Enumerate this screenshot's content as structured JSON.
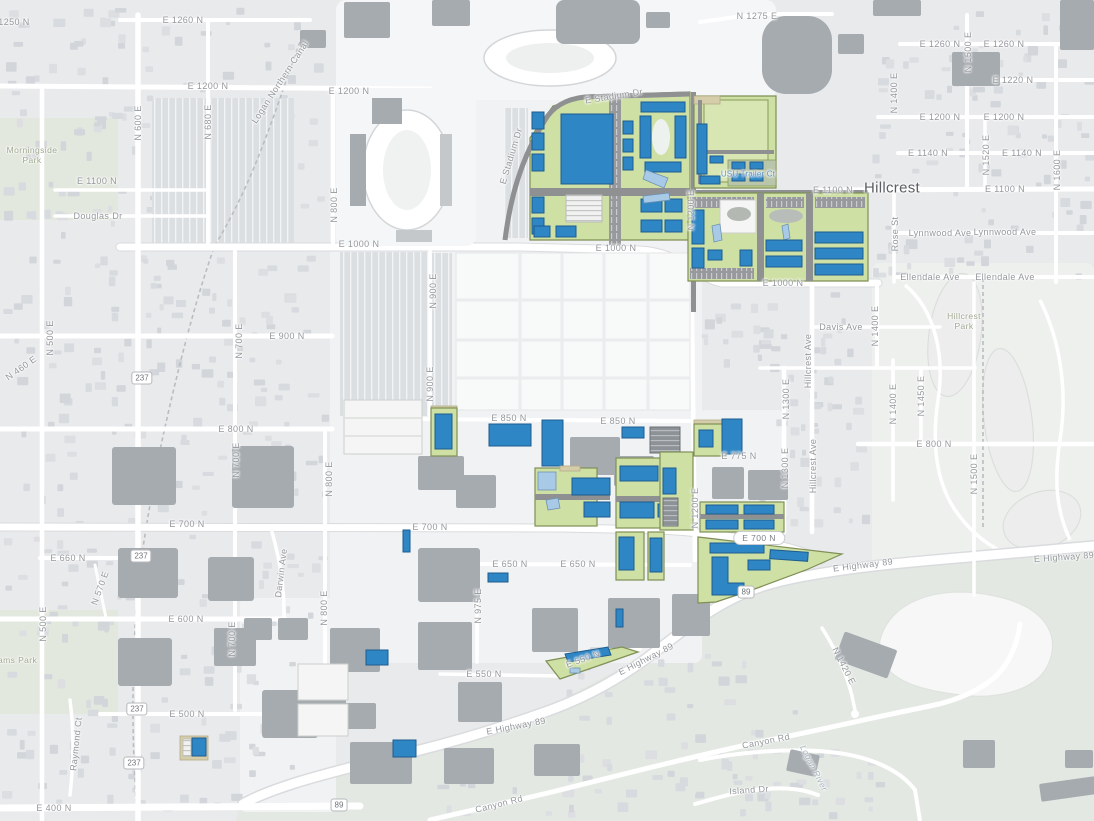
{
  "map": {
    "colors": {
      "background": "#e9eaec",
      "road": "#ffffff",
      "proposed_building_blue": "#2e86c5",
      "proposed_building_border": "#1d5c8e",
      "open_space_green": "#cfe0a5",
      "open_space_border": "#7f8f55",
      "water_feature_lightblue": "#a9cae6",
      "existing_building_gray": "#a6abb0",
      "street_label_gray": "#94989c"
    },
    "street_labels": [
      {
        "t": "1250 N",
        "x": 14,
        "y": 22
      },
      {
        "t": "E 1260 N",
        "x": 183,
        "y": 20
      },
      {
        "t": "E 1200 N",
        "x": 208,
        "y": 86
      },
      {
        "t": "E 1200 N",
        "x": 349,
        "y": 91
      },
      {
        "t": "E 1100 N",
        "x": 97,
        "y": 181
      },
      {
        "t": "Douglas Dr",
        "x": 98,
        "y": 216
      },
      {
        "t": "N 600 E",
        "x": 138,
        "y": 123,
        "r": -90
      },
      {
        "t": "N 680 E",
        "x": 208,
        "y": 122,
        "r": -90
      },
      {
        "t": "Logan Northern Canal",
        "x": 280,
        "y": 82,
        "r": -57
      },
      {
        "t": "N 1275 E",
        "x": 757,
        "y": 16
      },
      {
        "t": "E 1260 N",
        "x": 940,
        "y": 44
      },
      {
        "t": "E 1260 N",
        "x": 1004,
        "y": 44
      },
      {
        "t": "E 1220 N",
        "x": 1013,
        "y": 80
      },
      {
        "t": "E 1200 N",
        "x": 940,
        "y": 117
      },
      {
        "t": "E 1200 N",
        "x": 1004,
        "y": 117
      },
      {
        "t": "E 1140 N",
        "x": 928,
        "y": 153
      },
      {
        "t": "E 1140 N",
        "x": 1022,
        "y": 153
      },
      {
        "t": "N 1500 E",
        "x": 968,
        "y": 52,
        "r": -90
      },
      {
        "t": "N 1400 E",
        "x": 894,
        "y": 93,
        "r": -90
      },
      {
        "t": "N 1520 E",
        "x": 986,
        "y": 155,
        "r": -90
      },
      {
        "t": "N 1600 E",
        "x": 1057,
        "y": 170,
        "r": -90
      },
      {
        "t": "E 1100 N",
        "x": 833,
        "y": 190
      },
      {
        "t": "E 1100 N",
        "x": 1005,
        "y": 189
      },
      {
        "t": "Rose St",
        "x": 895,
        "y": 234,
        "r": -90
      },
      {
        "t": "Lynnwood Ave",
        "x": 940,
        "y": 233
      },
      {
        "t": "Lynnwood Ave",
        "x": 1005,
        "y": 232
      },
      {
        "t": "Ellendale Ave",
        "x": 930,
        "y": 277
      },
      {
        "t": "Ellendale Ave",
        "x": 1005,
        "y": 277
      },
      {
        "t": "E Stadium Dr",
        "x": 614,
        "y": 96,
        "r": -9
      },
      {
        "t": "E Stadium Dr",
        "x": 511,
        "y": 156,
        "r": -73
      },
      {
        "t": "N 800 E",
        "x": 334,
        "y": 205,
        "r": -90
      },
      {
        "t": "E 1000 N",
        "x": 359,
        "y": 244
      },
      {
        "t": "E 1000 N",
        "x": 616,
        "y": 248
      },
      {
        "t": "E 1000 N",
        "x": 783,
        "y": 283
      },
      {
        "t": "E 900 N",
        "x": 287,
        "y": 336
      },
      {
        "t": "N 900 E",
        "x": 433,
        "y": 291,
        "r": -90
      },
      {
        "t": "N 900 E",
        "x": 430,
        "y": 384,
        "r": -90
      },
      {
        "t": "N 500 E",
        "x": 50,
        "y": 338,
        "r": -90
      },
      {
        "t": "N 460 E",
        "x": 21,
        "y": 368,
        "r": -35
      },
      {
        "t": "N 700 E",
        "x": 239,
        "y": 341,
        "r": -90
      },
      {
        "t": "E 800 N",
        "x": 236,
        "y": 429
      },
      {
        "t": "E 800 N",
        "x": 934,
        "y": 444
      },
      {
        "t": "N 700 E",
        "x": 236,
        "y": 460,
        "r": -90
      },
      {
        "t": "E 850 N",
        "x": 509,
        "y": 418
      },
      {
        "t": "E 850 N",
        "x": 618,
        "y": 421
      },
      {
        "t": "Davis Ave",
        "x": 841,
        "y": 327
      },
      {
        "t": "N 1400 E",
        "x": 875,
        "y": 326,
        "r": -90
      },
      {
        "t": "Hillcrest Ave",
        "x": 808,
        "y": 361,
        "r": -90
      },
      {
        "t": "N 1300 E",
        "x": 786,
        "y": 399,
        "r": -90
      },
      {
        "t": "N 1400 E",
        "x": 893,
        "y": 404,
        "r": -90
      },
      {
        "t": "N 1450 E",
        "x": 921,
        "y": 396,
        "r": -90
      },
      {
        "t": "N 1500 E",
        "x": 974,
        "y": 474,
        "r": -90
      },
      {
        "t": "E 775 N",
        "x": 739,
        "y": 456
      },
      {
        "t": "Hillcrest Ave",
        "x": 813,
        "y": 466,
        "r": -90
      },
      {
        "t": "N 1300 E",
        "x": 785,
        "y": 468,
        "r": -90
      },
      {
        "t": "N 1200 E",
        "x": 695,
        "y": 508,
        "r": -90
      },
      {
        "t": "N 1200 E",
        "x": 691,
        "y": 210,
        "r": -90
      },
      {
        "t": "E 700 N",
        "x": 187,
        "y": 524
      },
      {
        "t": "E 700 N",
        "x": 430,
        "y": 527
      },
      {
        "t": "N 800 E",
        "x": 329,
        "y": 479,
        "r": -90
      },
      {
        "t": "N 800 E",
        "x": 324,
        "y": 608,
        "r": -90
      },
      {
        "t": "E 650 N",
        "x": 510,
        "y": 564
      },
      {
        "t": "E 650 N",
        "x": 578,
        "y": 564
      },
      {
        "t": "N 975 E",
        "x": 478,
        "y": 606,
        "r": -90
      },
      {
        "t": "E Highway 89",
        "x": 863,
        "y": 565,
        "r": -7
      },
      {
        "t": "E Highway 89",
        "x": 1064,
        "y": 557,
        "r": -4
      },
      {
        "t": "E 600 N",
        "x": 186,
        "y": 619
      },
      {
        "t": "E 660 N",
        "x": 68,
        "y": 558
      },
      {
        "t": "N 570 E",
        "x": 100,
        "y": 588,
        "r": -70
      },
      {
        "t": "N 500 E",
        "x": 43,
        "y": 624,
        "r": -90
      },
      {
        "t": "Darwin Ave",
        "x": 281,
        "y": 573,
        "r": -83
      },
      {
        "t": "N 700 E",
        "x": 232,
        "y": 639,
        "r": -90
      },
      {
        "t": "Raymond Ct",
        "x": 76,
        "y": 744,
        "r": -84
      },
      {
        "t": "E 500 N",
        "x": 187,
        "y": 714
      },
      {
        "t": "E 550 N",
        "x": 484,
        "y": 674
      },
      {
        "t": "E 550 N",
        "x": 583,
        "y": 659,
        "r": -20
      },
      {
        "t": "E 400 N",
        "x": 54,
        "y": 808
      },
      {
        "t": "E Highway 89",
        "x": 646,
        "y": 659,
        "r": -27
      },
      {
        "t": "E Highway 89",
        "x": 516,
        "y": 726,
        "r": -11
      },
      {
        "t": "Canyon Rd",
        "x": 499,
        "y": 804,
        "r": -14
      },
      {
        "t": "Canyon Rd",
        "x": 766,
        "y": 741,
        "r": -11
      },
      {
        "t": "Island Dr",
        "x": 749,
        "y": 790,
        "r": -4
      },
      {
        "t": "N 1420 E",
        "x": 844,
        "y": 666,
        "r": 63
      }
    ],
    "pill_labels": [
      {
        "t": "E 700 N",
        "x": 759,
        "y": 538
      }
    ],
    "place_labels": [
      {
        "t": "Hillcrest",
        "x": 892,
        "y": 188
      }
    ],
    "park_labels": [
      {
        "t": "Morningside\nPark",
        "x": 32,
        "y": 156
      },
      {
        "t": "Hillcrest\nPark",
        "x": 964,
        "y": 322
      },
      {
        "t": "Adams Park",
        "x": 12,
        "y": 661
      }
    ],
    "water_labels": [
      {
        "t": "Logan River",
        "x": 814,
        "y": 768,
        "r": 63
      }
    ],
    "poi_labels": [
      {
        "t": "USU Trailer Ct",
        "x": 748,
        "y": 174
      }
    ],
    "shield_labels": [
      {
        "t": "237",
        "x": 142,
        "y": 378
      },
      {
        "t": "237",
        "x": 141,
        "y": 556
      },
      {
        "t": "237",
        "x": 137,
        "y": 709
      },
      {
        "t": "237",
        "x": 134,
        "y": 763
      },
      {
        "t": "89",
        "x": 746,
        "y": 592
      },
      {
        "t": "89",
        "x": 339,
        "y": 805
      }
    ]
  }
}
